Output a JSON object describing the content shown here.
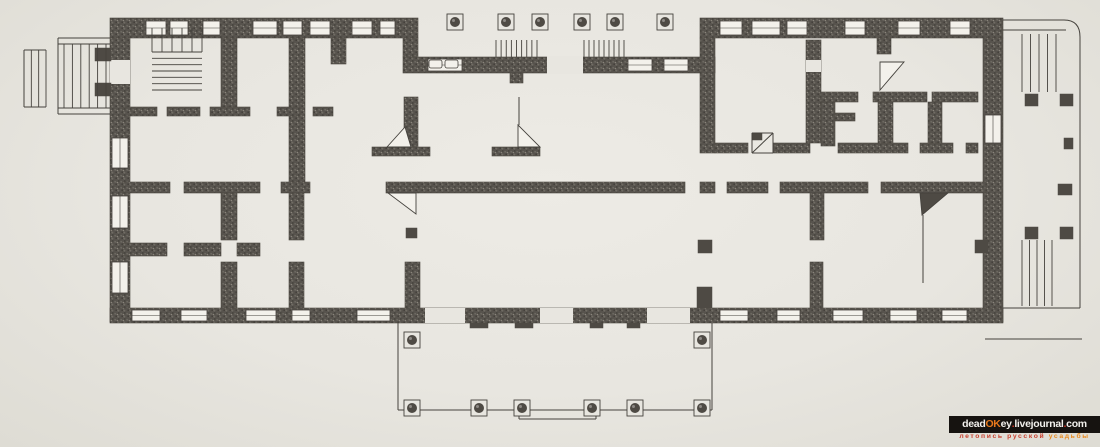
{
  "meta": {
    "subject": "Scanned one-storey floor plan of a classical Russian estate mansion with porticoes, terraces, column rows, corner stoves and staircases"
  },
  "palette": {
    "paper": "#e8e6e0",
    "wall_base": "#57534d",
    "wall_stroke": "#4c4842",
    "ink": "#45423d",
    "window_fill": "#f3f1eb",
    "dark_fill": "#4e4a44",
    "watermark_bar": "#161310",
    "watermark_white": "#f2f0ec",
    "watermark_orange": "#e8791c",
    "watermark_red": "#cc3526"
  },
  "watermark": {
    "line1": [
      {
        "t": "dead",
        "c": "#f2f0ec"
      },
      {
        "t": "OK",
        "c": "#e8791c"
      },
      {
        "t": "ey",
        "c": "#f2f0ec"
      },
      {
        "t": ".",
        "c": "#cc3526"
      },
      {
        "t": "livejournal",
        "c": "#f2f0ec"
      },
      {
        "t": ".",
        "c": "#cc3526"
      },
      {
        "t": "com",
        "c": "#f2f0ec"
      }
    ],
    "line2": [
      {
        "t": "летопись русской ",
        "c": "#c8402e"
      },
      {
        "t": "усадьбы",
        "c": "#e8891e"
      }
    ]
  },
  "plan": {
    "canvas": {
      "w": 1100,
      "h": 447
    },
    "walls": [
      [
        110,
        18,
        308,
        20
      ],
      [
        403,
        38,
        15,
        19
      ],
      [
        403,
        57,
        312,
        16
      ],
      [
        700,
        18,
        303,
        20
      ],
      [
        110,
        38,
        20,
        284
      ],
      [
        983,
        38,
        20,
        284
      ],
      [
        110,
        308,
        893,
        15
      ],
      [
        700,
        38,
        15,
        115
      ],
      [
        221,
        38,
        16,
        69
      ],
      [
        289,
        38,
        16,
        145
      ],
      [
        331,
        38,
        15,
        26
      ],
      [
        404,
        97,
        14,
        50
      ],
      [
        372,
        147,
        58,
        9
      ],
      [
        492,
        147,
        48,
        9
      ],
      [
        123,
        182,
        47,
        11
      ],
      [
        184,
        182,
        76,
        11
      ],
      [
        281,
        182,
        29,
        11
      ],
      [
        386,
        182,
        32,
        11
      ],
      [
        418,
        182,
        267,
        11
      ],
      [
        700,
        182,
        15,
        11
      ],
      [
        727,
        182,
        41,
        11
      ],
      [
        780,
        182,
        88,
        11
      ],
      [
        881,
        182,
        105,
        11
      ],
      [
        123,
        243,
        44,
        13
      ],
      [
        184,
        243,
        37,
        13
      ],
      [
        237,
        243,
        23,
        13
      ],
      [
        123,
        107,
        34,
        9
      ],
      [
        167,
        107,
        33,
        9
      ],
      [
        210,
        107,
        40,
        9
      ],
      [
        277,
        107,
        23,
        9
      ],
      [
        313,
        107,
        20,
        9
      ],
      [
        221,
        193,
        16,
        47
      ],
      [
        221,
        262,
        16,
        46
      ],
      [
        289,
        193,
        15,
        47
      ],
      [
        289,
        262,
        15,
        46
      ],
      [
        405,
        262,
        15,
        46
      ],
      [
        810,
        193,
        14,
        47
      ],
      [
        810,
        262,
        13,
        46
      ],
      [
        806,
        40,
        15,
        103
      ],
      [
        820,
        92,
        38,
        10
      ],
      [
        873,
        92,
        54,
        10
      ],
      [
        932,
        92,
        46,
        10
      ],
      [
        821,
        102,
        14,
        44
      ],
      [
        835,
        113,
        20,
        8
      ],
      [
        878,
        102,
        15,
        43
      ],
      [
        928,
        102,
        14,
        43
      ],
      [
        877,
        38,
        14,
        16
      ],
      [
        715,
        143,
        33,
        10
      ],
      [
        773,
        143,
        37,
        10
      ],
      [
        838,
        143,
        70,
        10
      ],
      [
        920,
        143,
        33,
        10
      ],
      [
        966,
        143,
        12,
        10
      ],
      [
        510,
        73,
        13,
        10
      ]
    ],
    "gaps": [
      [
        547,
        56,
        36,
        18
      ],
      [
        110,
        60,
        20,
        24
      ],
      [
        806,
        60,
        15,
        12
      ],
      [
        425,
        308,
        40,
        15
      ],
      [
        540,
        308,
        33,
        15
      ],
      [
        647,
        308,
        43,
        15
      ]
    ],
    "windows": [
      [
        146,
        21,
        20,
        14
      ],
      [
        170,
        21,
        18,
        14
      ],
      [
        203,
        21,
        17,
        14
      ],
      [
        253,
        21,
        24,
        14
      ],
      [
        283,
        21,
        19,
        14
      ],
      [
        310,
        21,
        20,
        14
      ],
      [
        352,
        21,
        20,
        14
      ],
      [
        380,
        21,
        15,
        14
      ],
      [
        720,
        21,
        22,
        14
      ],
      [
        752,
        21,
        28,
        14
      ],
      [
        787,
        21,
        20,
        14
      ],
      [
        845,
        21,
        20,
        14
      ],
      [
        898,
        21,
        22,
        14
      ],
      [
        950,
        21,
        20,
        14
      ],
      [
        428,
        59,
        34,
        12
      ],
      [
        628,
        59,
        24,
        12
      ],
      [
        664,
        59,
        24,
        12
      ],
      [
        132,
        310,
        28,
        11
      ],
      [
        181,
        310,
        26,
        11
      ],
      [
        246,
        310,
        30,
        11
      ],
      [
        292,
        310,
        18,
        11
      ],
      [
        357,
        310,
        33,
        11
      ],
      [
        720,
        310,
        28,
        11
      ],
      [
        777,
        310,
        23,
        11
      ],
      [
        833,
        310,
        30,
        11
      ],
      [
        890,
        310,
        27,
        11
      ],
      [
        942,
        310,
        25,
        11
      ],
      [
        112,
        138,
        16,
        30
      ],
      [
        112,
        196,
        16,
        32
      ],
      [
        112,
        262,
        16,
        31
      ],
      [
        985,
        115,
        16,
        28
      ]
    ],
    "leaf_rects": [
      [
        429,
        60,
        13,
        8
      ],
      [
        445,
        60,
        13,
        8
      ]
    ],
    "darks": [
      [
        95,
        48,
        16,
        13
      ],
      [
        95,
        83,
        16,
        13
      ],
      [
        470,
        323,
        18,
        5
      ],
      [
        515,
        323,
        18,
        5
      ],
      [
        590,
        323,
        13,
        5
      ],
      [
        627,
        323,
        13,
        5
      ],
      [
        698,
        240,
        14,
        13
      ],
      [
        697,
        287,
        15,
        21
      ],
      [
        406,
        228,
        11,
        10
      ],
      [
        975,
        240,
        13,
        13
      ],
      [
        1025,
        94,
        13,
        12
      ],
      [
        1060,
        94,
        13,
        12
      ],
      [
        1064,
        138,
        9,
        11
      ],
      [
        1058,
        184,
        14,
        11
      ],
      [
        1025,
        227,
        13,
        12
      ],
      [
        1060,
        227,
        13,
        12
      ],
      [
        752,
        133,
        10,
        7
      ]
    ],
    "stairs": [
      {
        "x": 152,
        "y": 28,
        "w": 50,
        "h": 24,
        "n": 6,
        "dir": "v"
      },
      {
        "x": 152,
        "y": 52,
        "w": 50,
        "h": 38,
        "n": 7,
        "dir": "h"
      },
      {
        "x": 496,
        "y": 40,
        "w": 41,
        "h": 17,
        "n": 9,
        "dir": "v"
      },
      {
        "x": 584,
        "y": 40,
        "w": 40,
        "h": 17,
        "n": 9,
        "dir": "v"
      },
      {
        "x": 64,
        "y": 44,
        "w": 42,
        "h": 64,
        "n": 6,
        "dir": "v"
      },
      {
        "x": 24,
        "y": 50,
        "w": 22,
        "h": 57,
        "n": 4,
        "dir": "v"
      },
      {
        "x": 1022,
        "y": 34,
        "w": 34,
        "h": 58,
        "n": 5,
        "dir": "v"
      },
      {
        "x": 1022,
        "y": 240,
        "w": 30,
        "h": 66,
        "n": 5,
        "dir": "v"
      }
    ],
    "lines": [
      [
        58,
        38,
        110,
        38
      ],
      [
        58,
        44,
        110,
        44
      ],
      [
        58,
        108,
        110,
        108
      ],
      [
        58,
        114,
        110,
        114
      ],
      [
        58,
        38,
        58,
        114
      ],
      [
        24,
        50,
        46,
        50
      ],
      [
        24,
        107,
        46,
        107
      ],
      [
        24,
        50,
        24,
        107
      ],
      [
        398,
        323,
        398,
        410
      ],
      [
        398,
        410,
        712,
        410
      ],
      [
        712,
        323,
        712,
        410
      ],
      [
        519,
        411,
        519,
        419
      ],
      [
        519,
        419,
        596,
        419
      ],
      [
        596,
        411,
        596,
        419
      ],
      [
        923,
        215,
        923,
        283
      ],
      [
        519,
        97,
        519,
        125
      ],
      [
        1003,
        308,
        1080,
        308
      ],
      [
        985,
        339,
        1082,
        339
      ],
      [
        1003,
        30,
        1066,
        30
      ],
      [
        752,
        133,
        773,
        133
      ],
      [
        773,
        133,
        773,
        153
      ],
      [
        752,
        153,
        773,
        153
      ],
      [
        752,
        133,
        752,
        153
      ],
      [
        752,
        153,
        773,
        133
      ]
    ],
    "paths": [
      "M1003,20 L1064,20 Q1080,20 1080,37 L1080,308"
    ],
    "columns": [
      [
        455,
        22
      ],
      [
        506,
        22
      ],
      [
        540,
        22
      ],
      [
        582,
        22
      ],
      [
        615,
        22
      ],
      [
        665,
        22
      ],
      [
        412,
        340
      ],
      [
        702,
        340
      ],
      [
        412,
        408
      ],
      [
        479,
        408
      ],
      [
        522,
        408
      ],
      [
        592,
        408
      ],
      [
        635,
        408
      ],
      [
        702,
        408
      ]
    ],
    "stoves": [
      {
        "pts": "387,147 411,147 405,127",
        "fill": "light"
      },
      {
        "pts": "518,125 540,147 518,147",
        "fill": "light"
      },
      {
        "pts": "880,62 904,62 880,90",
        "fill": "light"
      },
      {
        "pts": "388,193 416,193 416,214",
        "fill": "light"
      },
      {
        "pts": "920,193 948,193 922,215",
        "fill": "dark"
      }
    ]
  }
}
